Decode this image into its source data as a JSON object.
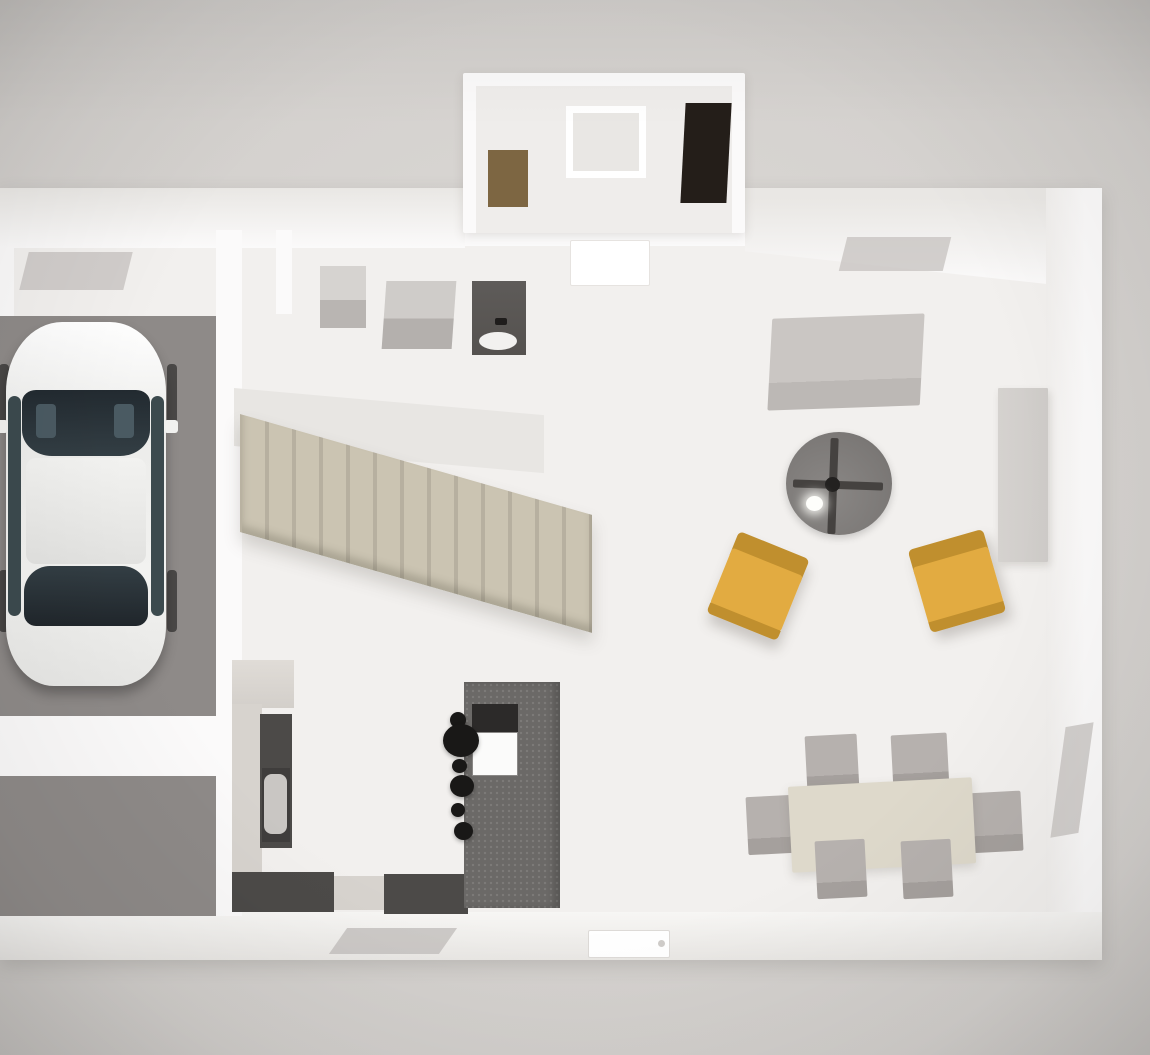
{
  "scene": {
    "description": "3D top-down architectural render of a house ground floor plan",
    "rooms": [
      "garage",
      "entry porch",
      "utility room",
      "staircase",
      "kitchen",
      "living room",
      "dining area"
    ],
    "objects": {
      "garage": [
        "white sedan car viewed from above",
        "two gray floor bays divided by a wall"
      ],
      "porch": [
        "brown door mat",
        "white framed window",
        "dark front door"
      ],
      "utility": [
        "light gray appliance",
        "gray appliance",
        "dark vanity with white sink"
      ],
      "staircase": [
        "beige straight stair run descending left to right",
        "gray landing"
      ],
      "kitchen": [
        "L-shaped counter with dark worktop",
        "sink with basin",
        "dishwasher front",
        "speckled gray island",
        "dark cooktop",
        "white island sink",
        "six black pendant spheres"
      ],
      "living": [
        "light gray sofa",
        "round gray rug",
        "ceiling fan with dark blades",
        "glowing ceiling light spot",
        "two mustard yellow armchairs",
        "tall light gray cabinet",
        "white entry mat"
      ],
      "dining": [
        "beige rectangular table",
        "six gray chairs"
      ],
      "walls": [
        "white perimeter walls",
        "gray daylight window shadows on wall faces",
        "white exterior door on bottom wall"
      ]
    }
  },
  "colors": {
    "bg": "#d8d5d2",
    "wall": "#fbfafa",
    "wallFace": "#e9e7e4",
    "floor": "#f2f0ee",
    "protrusionFloor": "#efedeb",
    "garageFloor": "#8e8a88",
    "stairs": "#cbc4b2",
    "stairsEdge": "#b7b0a0",
    "landing": "#e8e6e3",
    "counterDark": "#4c4a48",
    "counterLight": "#d7d3ce",
    "island": "#6b6967",
    "applianceLight": "#d6d3d0",
    "applianceMid": "#b9b5b2",
    "vanity": "#55524f",
    "pendantBlack": "#191817",
    "carBody": "#f2f2f0",
    "carGlass": "#333e44",
    "rug": "#7b7876",
    "fanBlade": "#454240",
    "chairYellow": "#e2ab41",
    "chairYellowDark": "#c08f2e",
    "sofa": "#cac6c3",
    "diningTable": "#ded9cb",
    "diningChair": "#b6b1ae",
    "tallCabinet": "#cecbc8",
    "woodMat": "#7d6642",
    "doorDark": "#241e19",
    "windowShadow": "#c5c2bf",
    "matWhite": "#ffffff"
  }
}
